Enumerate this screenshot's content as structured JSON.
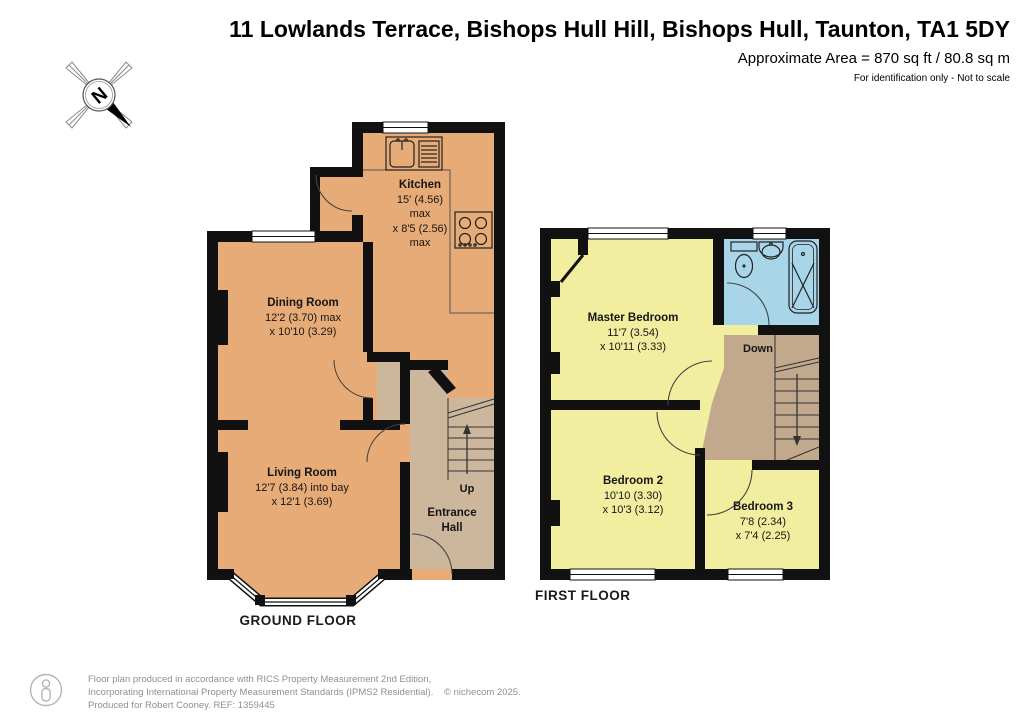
{
  "header": {
    "title": "11 Lowlands Terrace, Bishops Hull Hill, Bishops Hull, Taunton, TA1 5DY",
    "area_line": "Approximate Area = 870 sq ft / 80.8 sq m",
    "disclaimer": "For identification only - Not to scale"
  },
  "compass": {
    "north_label": "N"
  },
  "floors": {
    "ground": {
      "label": "GROUND FLOOR",
      "rooms": {
        "kitchen": {
          "name": "Kitchen",
          "dims": [
            "15' (4.56)",
            "max",
            "x 8'5 (2.56)",
            "max"
          ]
        },
        "dining": {
          "name": "Dining Room",
          "dims": [
            "12'2 (3.70) max",
            "x 10'10 (3.29)"
          ]
        },
        "living": {
          "name": "Living Room",
          "dims": [
            "12'7 (3.84) into bay",
            "x 12'1 (3.69)"
          ]
        },
        "hall": {
          "name_line1": "Entrance",
          "name_line2": "Hall"
        }
      },
      "stairs_label": "Up"
    },
    "first": {
      "label": "FIRST FLOOR",
      "rooms": {
        "master": {
          "name": "Master Bedroom",
          "dims": [
            "11'7 (3.54)",
            "x 10'11 (3.33)"
          ]
        },
        "bedroom2": {
          "name": "Bedroom 2",
          "dims": [
            "10'10 (3.30)",
            "x 10'3 (3.12)"
          ]
        },
        "bedroom3": {
          "name": "Bedroom 3",
          "dims": [
            "7'8 (2.34)",
            "x 7'4 (2.25)"
          ]
        }
      },
      "stairs_label": "Down"
    }
  },
  "footer": {
    "line1": "Floor plan produced in accordance with RICS Property Measurement 2nd Edition,",
    "line2": "Incorporating International Property Measurement Standards (IPMS2 Residential).",
    "copyright": "© nichecom 2025.",
    "line3": "Produced for Robert Cooney.   REF: 1359445"
  },
  "colors": {
    "wall": "#111111",
    "reception_orange": "#E6AB76",
    "hall_tan": "#CDB79C",
    "landing_tan": "#C2A88C",
    "bedroom_yellow": "#F1EEA0",
    "bathroom_blue": "#A9D5E8"
  }
}
